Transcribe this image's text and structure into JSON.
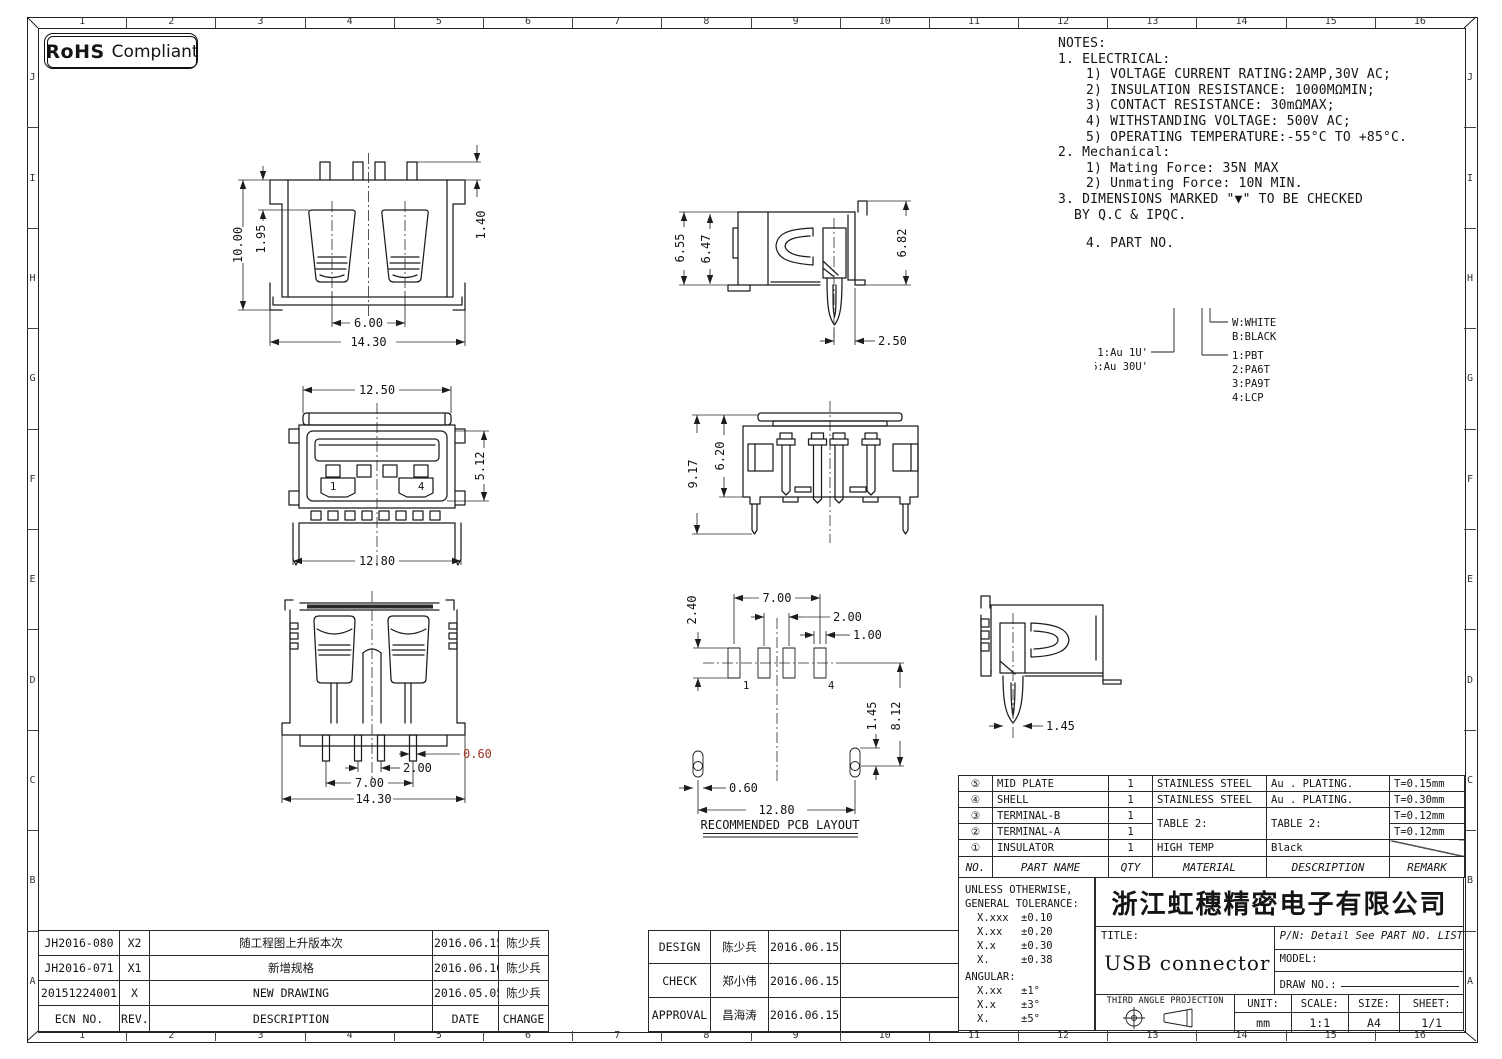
{
  "colors": {
    "line": "#1c1c1c",
    "dim_red": "#9c3522",
    "paper": "#ffffff"
  },
  "grid": {
    "cols": [
      "1",
      "2",
      "3",
      "4",
      "5",
      "6",
      "7",
      "8",
      "9",
      "10",
      "11",
      "12",
      "13",
      "14",
      "15",
      "16"
    ],
    "rows": [
      "J",
      "I",
      "H",
      "G",
      "F",
      "E",
      "D",
      "C",
      "B",
      "A"
    ]
  },
  "stamp": {
    "rohs": "RoHS",
    "compliant": "Compliant"
  },
  "notes": {
    "lines": [
      "NOTES:",
      "1. ELECTRICAL:",
      "1) VOLTAGE CURRENT RATING:2AMP,30V AC;",
      "2) INSULATION RESISTANCE: 1000MΩMIN;",
      "3) CONTACT RESISTANCE: 30mΩMAX;",
      "4) WITHSTANDING VOLTAGE: 500V AC;",
      "5) OPERATING TEMPERATURE:-55°C TO +85°C.",
      "2. Mechanical:",
      "1) Mating Force: 35N  MAX",
      "2) Unmating Force: 10N  MIN.",
      "3. DIMENSIONS MARKED \"▼\" TO BE CHECKED",
      "BY Q.C & IPQC.",
      "4. PART NO."
    ]
  },
  "part_no_legend": {
    "plating": [
      "1:Au 1U'",
      "6:Au 30U'"
    ],
    "colors": [
      "W:WHITE",
      "B:BLACK"
    ],
    "materials": [
      "1:PBT",
      "2:PA6T",
      "3:PA9T",
      "4:LCP"
    ]
  },
  "views": {
    "front": {
      "dims": {
        "height": "10.00",
        "slot_top": "1.95",
        "tab": "1.40",
        "slot_pitch": "6.00",
        "width": "14.30"
      }
    },
    "side": {
      "dims": {
        "outer_h": "6.55",
        "inner_h": "6.47",
        "right_h": "6.82",
        "pin_offset": "2.50"
      }
    },
    "face": {
      "dims": {
        "cover_w": "12.50",
        "opening_h": "5.12",
        "body_w": "12.80"
      },
      "pin1": "1",
      "pin4": "4"
    },
    "rear": {
      "dims": {
        "total_h": "9.17",
        "body_h": "6.20"
      }
    },
    "bottom": {
      "dims": {
        "pin_w": "0.60",
        "pin_pitch": "2.00",
        "pin_span": "7.00",
        "width": "14.30"
      }
    },
    "pcb": {
      "caption": "RECOMMENDED PCB LAYOUT",
      "pin1": "1",
      "pin4": "4",
      "dims": {
        "pad_h": "2.40",
        "pad_span": "7.00",
        "pad_pitch": "2.00",
        "pad_w": "1.00",
        "hole_offset": "1.45",
        "row_offset": "8.12",
        "hole_w": "0.60",
        "hole_span": "12.80"
      }
    },
    "side2": {
      "dims": {
        "pin_w": "1.45"
      }
    }
  },
  "bom": {
    "headers": {
      "no": "NO.",
      "part": "PART NAME",
      "qty": "QTY",
      "material": "MATERIAL",
      "description": "DESCRIPTION",
      "remark": "REMARK"
    },
    "rows": [
      {
        "no": "⑤",
        "part": "MID PLATE",
        "qty": "1",
        "material": "STAINLESS STEEL",
        "description": "Au . PLATING.",
        "remark": "T=0.15mm"
      },
      {
        "no": "④",
        "part": "SHELL",
        "qty": "1",
        "material": "STAINLESS STEEL",
        "description": "Au . PLATING.",
        "remark": "T=0.30mm"
      },
      {
        "no": "③",
        "part": "TERMINAL-B",
        "qty": "1",
        "material": "TABLE 2:",
        "description": "TABLE 2:",
        "remark": "T=0.12mm"
      },
      {
        "no": "②",
        "part": "TERMINAL-A",
        "qty": "1",
        "remark": "T=0.12mm"
      },
      {
        "no": "①",
        "part": "INSULATOR",
        "qty": "1",
        "material": "HIGH TEMP",
        "description": "Black",
        "remark": ""
      }
    ]
  },
  "tolerance": {
    "line1": "UNLESS OTHERWISE,",
    "line2": "GENERAL TOLERANCE:",
    "rows": [
      [
        "X.xxx",
        "±0.10"
      ],
      [
        "X.xx",
        "±0.20"
      ],
      [
        "X.x",
        "±0.30"
      ],
      [
        "X.",
        "±0.38"
      ]
    ],
    "angular": "ANGULAR:",
    "angular_rows": [
      [
        "X.xx",
        "±1°"
      ],
      [
        "X.x",
        "±3°"
      ],
      [
        "X.",
        "±5°"
      ]
    ]
  },
  "title_block": {
    "company": "浙江虹穗精密电子有限公司",
    "title_label": "TITLE:",
    "title": "USB connector",
    "pn": "P/N: Detail See PART NO. LIST",
    "model_label": "MODEL:",
    "draw_label": "DRAW NO.:",
    "projection": "THIRD ANGLE PROJECTION",
    "unit_label": "UNIT:",
    "unit": "mm",
    "scale_label": "SCALE:",
    "scale": "1:1",
    "size_label": "SIZE:",
    "size": "A4",
    "sheet_label": "SHEET:",
    "sheet": "1/1"
  },
  "revision": {
    "headers": {
      "ecn": "ECN NO.",
      "rev": "REV.",
      "description": "DESCRIPTION",
      "date": "DATE",
      "change": "CHANGE"
    },
    "rows": [
      {
        "ecn": "JH2016-080",
        "rev": "X2",
        "description": "随工程图上升版本次",
        "date": "2016.06.15",
        "change": "陈少兵"
      },
      {
        "ecn": "JH2016-071",
        "rev": "X1",
        "description": "新增规格",
        "date": "2016.06.10",
        "change": "陈少兵"
      },
      {
        "ecn": "20151224001",
        "rev": "X",
        "description": "NEW DRAWING",
        "date": "2016.05.05",
        "change": "陈少兵"
      }
    ]
  },
  "approval": {
    "rows": [
      {
        "role": "DESIGN",
        "name": "陈少兵",
        "date": "2016.06.15"
      },
      {
        "role": "CHECK",
        "name": "郑小伟",
        "date": "2016.06.15"
      },
      {
        "role": "APPROVAL",
        "name": "昌海涛",
        "date": "2016.06.15"
      }
    ]
  }
}
